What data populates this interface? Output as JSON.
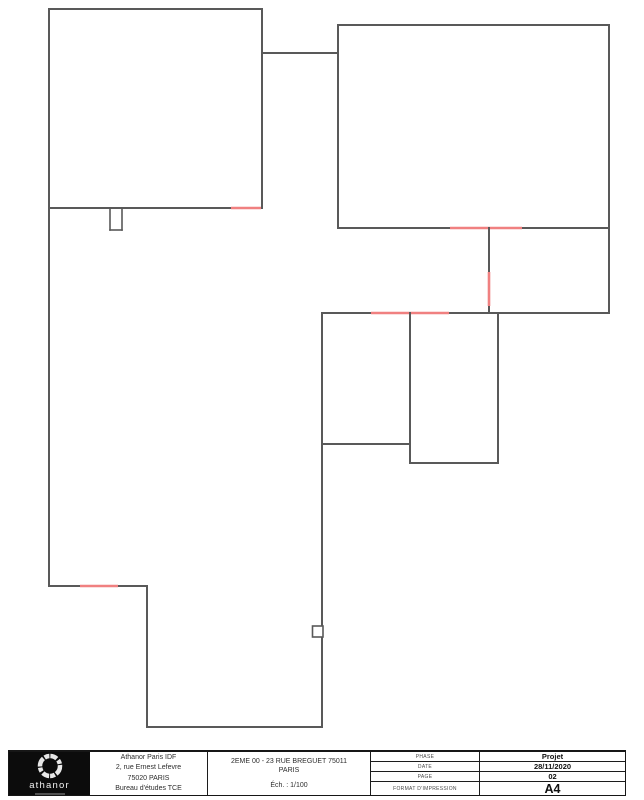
{
  "plan": {
    "description": "2nd floor wall plan with demolition openings",
    "colors": {
      "wall": "#595959",
      "opening": "#f08080"
    }
  },
  "title_block": {
    "logo": {
      "brand": "athanor"
    },
    "company": {
      "lines": [
        "Athanor Paris IDF",
        "2, rue Ernest Lefevre",
        "75020 PARIS",
        "Bureau d'études TCE"
      ]
    },
    "project": {
      "title_line1": "2EME 00 - 23 RUE BREGUET 75011",
      "title_line2": "PARIS",
      "scale": "Éch. : 1/100"
    },
    "info": {
      "rows": [
        {
          "label": "PHASE",
          "value": "Projet"
        },
        {
          "label": "DATE",
          "value": "28/11/2020"
        },
        {
          "label": "PAGE",
          "value": "02"
        },
        {
          "label": "FORMAT D'IMPRESSION",
          "value": "A4"
        }
      ]
    }
  }
}
